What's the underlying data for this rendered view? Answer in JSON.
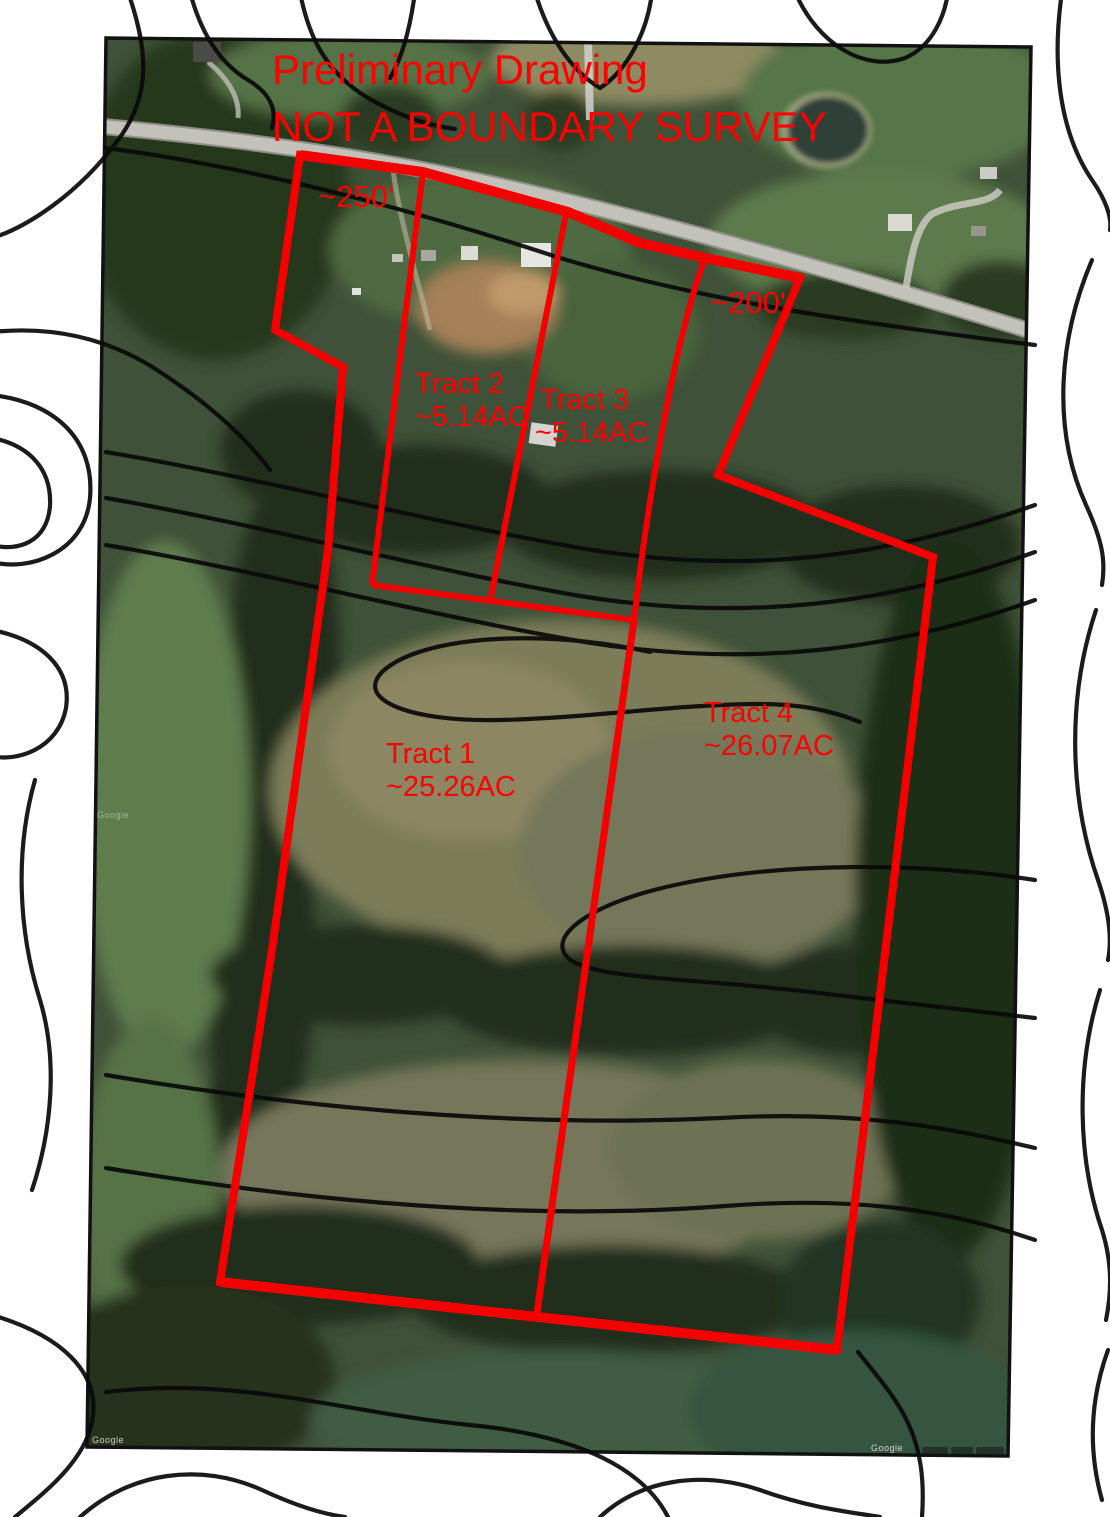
{
  "document": {
    "title_line1": "Preliminary Drawing",
    "title_line2": "NOT A BOUNDARY SURVEY"
  },
  "annotations": {
    "distance_labels": [
      "~250'",
      "~200'"
    ],
    "tracts": [
      {
        "name": "Tract 1",
        "area": "~25.26AC"
      },
      {
        "name": "Tract 2",
        "area": "~5.14AC"
      },
      {
        "name": "Tract 3",
        "area": "~5.14AC"
      },
      {
        "name": "Tract 4",
        "area": "~26.07AC"
      }
    ]
  },
  "watermarks": {
    "google": "Google"
  },
  "colors": {
    "boundary_red": "#f40000",
    "label_red": "#ff0000",
    "contour_black": "#0a0a0a"
  }
}
